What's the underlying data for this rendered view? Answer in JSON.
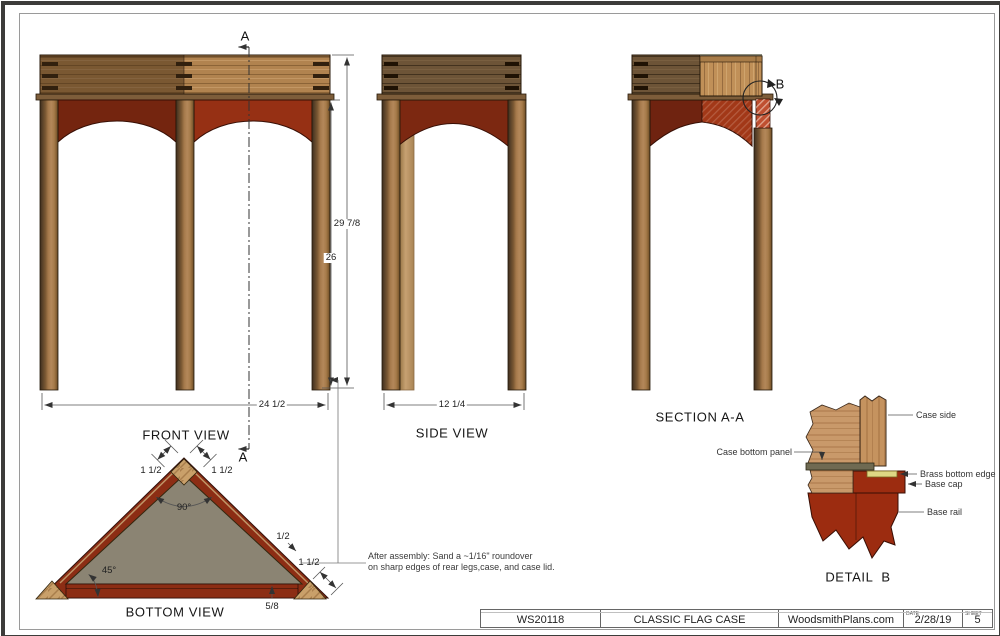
{
  "labels": {
    "front_view": "FRONT VIEW",
    "side_view": "SIDE VIEW",
    "section": "SECTION A-A",
    "bottom_view": "BOTTOM VIEW",
    "detail": "DETAIL  B"
  },
  "section_markers": {
    "a": "A",
    "b": "B"
  },
  "dimensions": {
    "front_width": "24 1/2",
    "front_total_height": "29 7/8",
    "front_leg_height": "26",
    "side_width": "12 1/4",
    "bottom_edge_left": "1 1/2",
    "bottom_edge_right": "1 1/2",
    "bottom_apex_angle": "90°",
    "bottom_base_angle": "45°",
    "bottom_side_thickness": "1/2",
    "bottom_corner_block": "1 1/2",
    "bottom_base_thickness": "5/8"
  },
  "callouts": {
    "case_side": "Case side",
    "case_bottom_panel": "Case bottom panel",
    "brass_bottom_edge": "Brass bottom edge",
    "base_cap": "Base cap",
    "base_rail": "Base rail"
  },
  "note": {
    "line1": "After assembly: Sand a ~1/16\" roundover",
    "line2": "on sharp edges of rear legs,case, and case lid."
  },
  "title_block": {
    "plan_number": "WS20118",
    "title": "CLASSIC FLAG CASE",
    "website": "WoodsmithPlans.com",
    "date_label": "DATE",
    "date": "2/28/19",
    "sheet_label": "SHEET",
    "sheet": "5"
  },
  "colors": {
    "wood_light": "#b1834f",
    "wood_dark": "#6d5437",
    "apron_red": "#963014",
    "apron_red_dark": "#74250f",
    "panel_olive": "#8b8473",
    "brass": "#ded784",
    "base_red": "#9c2c10"
  }
}
